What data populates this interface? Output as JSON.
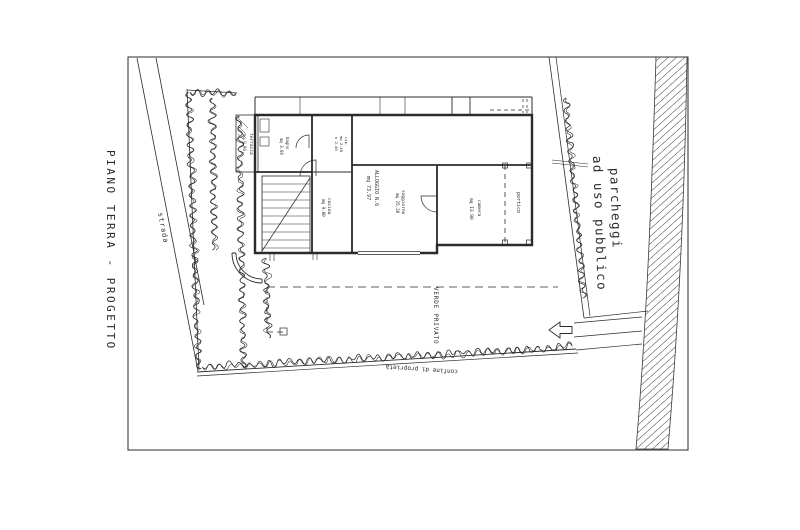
{
  "colors": {
    "paper": "#ffffff",
    "ink": "#2b2b2b"
  },
  "title": {
    "text": "PIANO TERRA - PROGETTO"
  },
  "plan": {
    "labels": {
      "strada": "strada",
      "terrazza": "terrazza",
      "terrazza_mq": "mq 0.90",
      "bagno": "bagno",
      "bagno_mq": "mq 3.80",
      "rip_1": "rip.",
      "rip_2": "mq 2.40",
      "rip_3": "h 2.40",
      "cucina": "cucina",
      "cucina_mq": "mq 9.80",
      "alloggio_1": "ALLOGGIO N.6",
      "alloggio_2": "mq 73.97",
      "soggiorno": "soggiorno",
      "soggiorno_mq": "mq 25.20",
      "camera": "camera",
      "camera_mq": "mq 13.90",
      "portico": "portico",
      "verde_privato": "VERDE PRIVATO",
      "confine": "confine di proprietà",
      "parcheggi_1": "parcheggi",
      "parcheggi_2": "ad uso pubblico"
    }
  }
}
